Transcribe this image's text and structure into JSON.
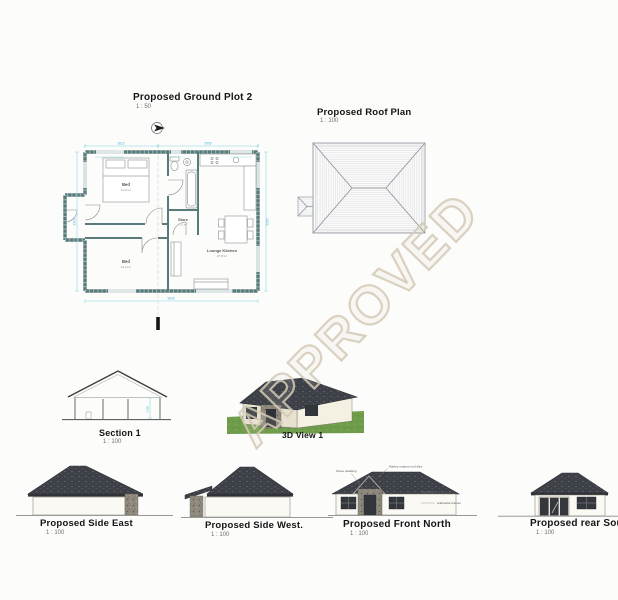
{
  "watermark": {
    "text": "APPROVED",
    "color": "#d3c9b5"
  },
  "ground_plan": {
    "title": "Proposed Ground Plot 2",
    "scale": "1 : 50",
    "rooms": {
      "bed1": {
        "name": "Bed",
        "area": "11.9 m²"
      },
      "bed2": {
        "name": "Bed",
        "area": "11.2 m²"
      },
      "store": {
        "name": "Store",
        "area": "1.6 m²"
      },
      "lounge": {
        "name": "Lounge Kitchen",
        "area": "27.8 m²"
      }
    },
    "dims": {
      "top_left": "3613",
      "top_right": "5995",
      "bottom": "9935",
      "left": "3313",
      "right": "5050"
    }
  },
  "roof_plan": {
    "title": "Proposed Roof Plan",
    "scale": "1 : 100"
  },
  "section": {
    "title": "Section 1",
    "scale": "1 : 100",
    "dim": "2400"
  },
  "view3d": {
    "title": "3D View 1"
  },
  "elevations": [
    {
      "title": "Proposed Side East",
      "scale": "1 : 100"
    },
    {
      "title": "Proposed Side West.",
      "scale": "1 : 100"
    },
    {
      "title": "Proposed Front North",
      "scale": "1 : 100"
    },
    {
      "title": "Proposed rear South",
      "scale": "1 : 100"
    }
  ],
  "front_annotations": {
    "stone": "Stone cladding",
    "roof": "Marley modern roof tiles",
    "render": "white render",
    "frames": "anthracite frames"
  },
  "colors": {
    "wall": "#587a7a",
    "dimension": "#5bbdd4",
    "roof_dark": "#3d4147",
    "grass": "#6f9c4b",
    "stone": "#8e897c"
  }
}
